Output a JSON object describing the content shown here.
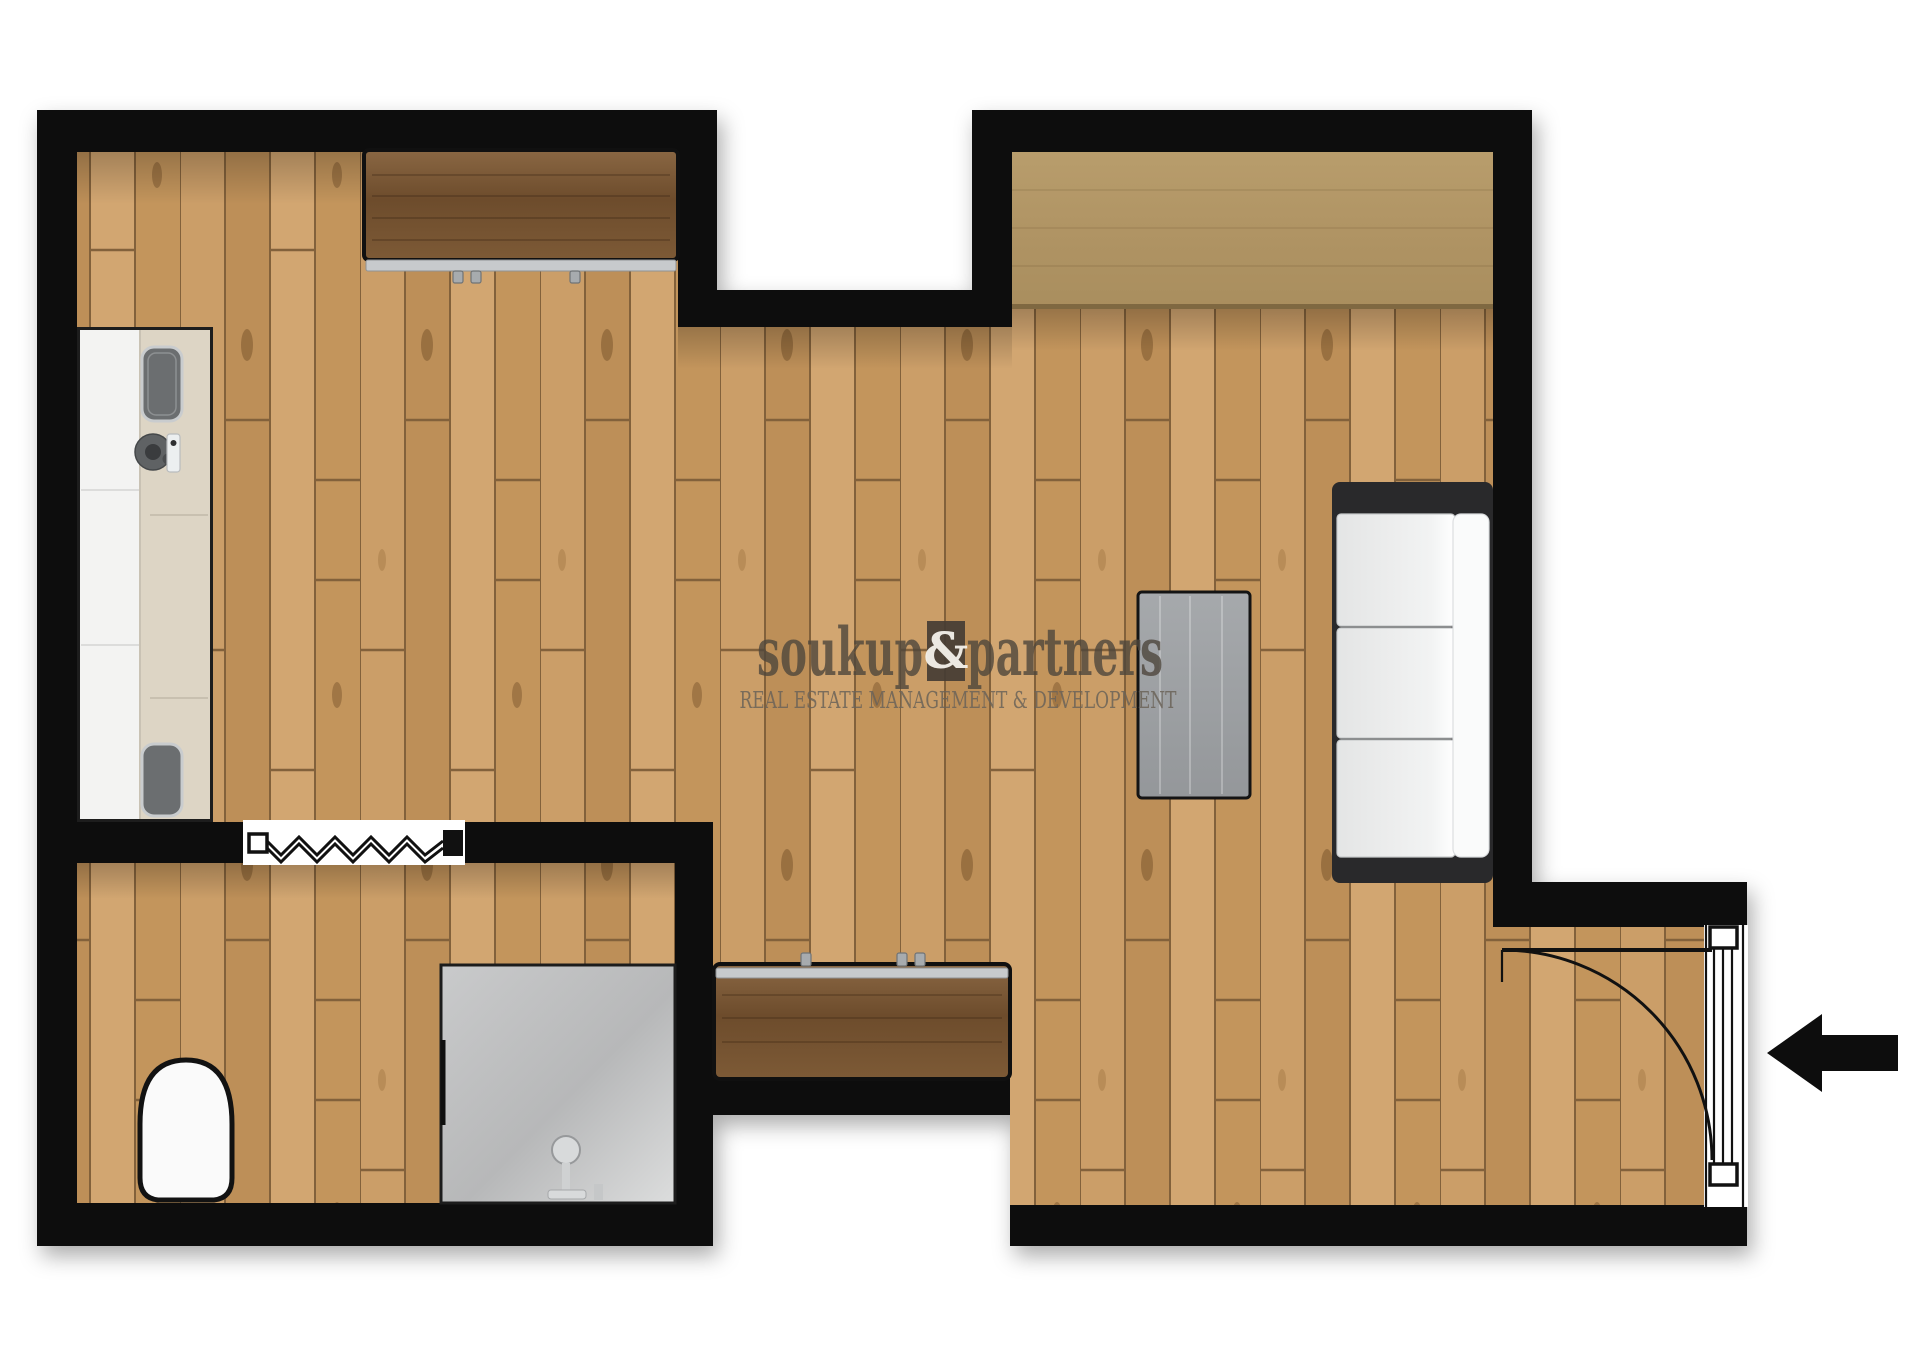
{
  "watermark": {
    "brand_left": "soukup",
    "brand_amp": "&",
    "brand_right": "partners",
    "tagline": "REAL ESTATE MANAGEMENT & DEVELOPMENT"
  },
  "palette": {
    "wall": "#0b0b0b",
    "floor_base": "#c79a63",
    "floor_seam": "#80603a",
    "cabinet_wood": "#74522f",
    "wardrobe_wood": "#b59a68",
    "counter_beige": "#ddd5c5",
    "counter_white": "#f3f3f2",
    "metal_trim": "#c7cacc",
    "sofa_frame": "#29292b",
    "sofa_cushion": "#e9eaea",
    "table_gray": "#9da0a3",
    "shower_gray": "#c5c6c7",
    "watermark_text": "#4e463c",
    "watermark_box": "#453d34",
    "watermark_tagline": "#6b6358"
  },
  "elements": [
    {
      "name": "walls",
      "label": "wall-outline"
    },
    {
      "name": "kitchen-counter",
      "label": "counter-with-sink-and-cooktop"
    },
    {
      "name": "desk",
      "label": "cabinet-desk"
    },
    {
      "name": "wardrobe",
      "label": "wardrobe"
    },
    {
      "name": "sofa",
      "label": "three-seat-sofa"
    },
    {
      "name": "coffee-table",
      "label": "coffee-table"
    },
    {
      "name": "sideboard",
      "label": "hall-sideboard"
    },
    {
      "name": "toilet",
      "label": "toilet"
    },
    {
      "name": "shower",
      "label": "shower-enclosure"
    },
    {
      "name": "interior-window-radiator",
      "label": "window-with-radiator-zigzag"
    },
    {
      "name": "entrance-door",
      "label": "door-with-swing-arc"
    },
    {
      "name": "entrance-arrow",
      "label": "entrance-direction-arrow"
    }
  ]
}
